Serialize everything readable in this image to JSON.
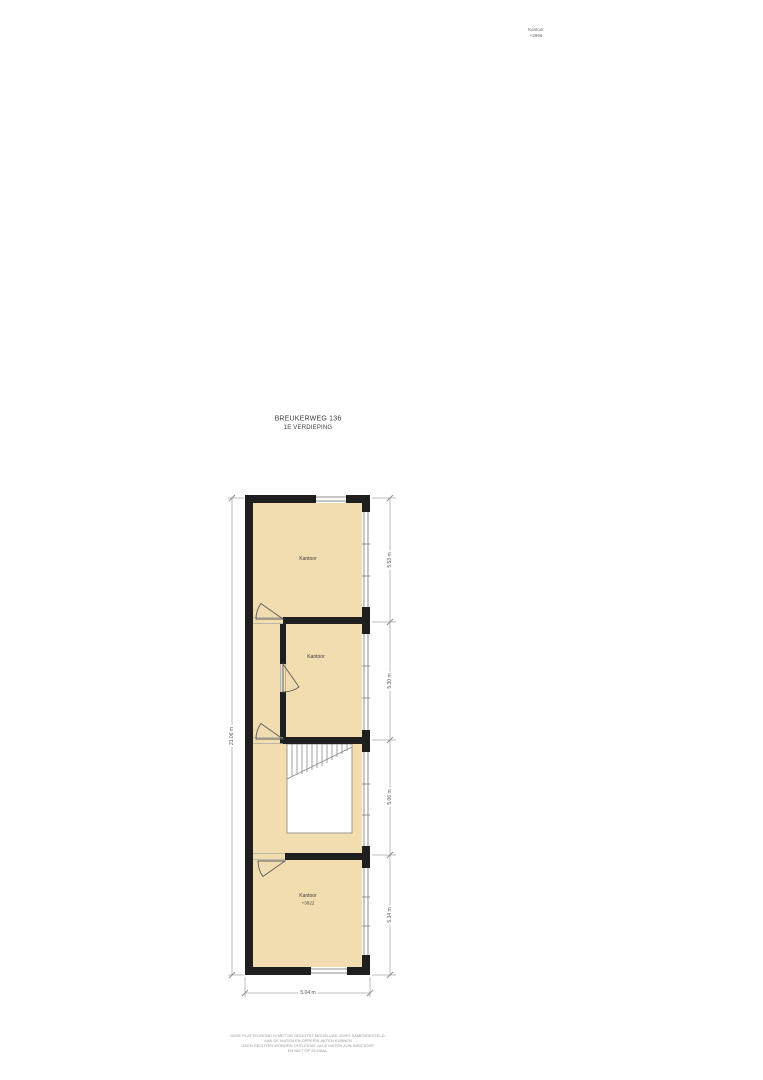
{
  "colors": {
    "room_fill": "#f2ddb0",
    "wall": "#1f1f1f",
    "window_line": "#8f8f8f",
    "dim_line": "#bdbdbd",
    "dim_text": "#555555",
    "label_text": "#3c3c3c",
    "muted_text": "#8f8f8f"
  },
  "header": {
    "address": "BREUKERWEG 136",
    "floor": "1E VERDIEPING"
  },
  "adjacent_fragment": {
    "room": "Kantoor",
    "elevation": "+2966"
  },
  "rooms": {
    "top": {
      "label": "Kantoor"
    },
    "middle": {
      "label": "Kantoor"
    },
    "bottom": {
      "label": "Kantoor",
      "elevation": "+3022"
    }
  },
  "dimensions": {
    "left_total": "21.06 m",
    "right_segment_1": "5.53 m",
    "right_segment_2": "5.30 m",
    "right_segment_3": "5.06 m",
    "right_segment_4": "5.34 m",
    "bottom_width": "5.04 m"
  },
  "disclaimer": {
    "line1": "DEZE PLATTEGROND IS MET DE GROOTST MOGELIJKE ZORG SAMENGESTELD,",
    "line2": "AAN DE MATEN EN OPPERVLAKTEN KUNNEN",
    "line3": "GEEN RECHTEN WORDEN ONTLEEND. ALLE MATEN ZIJN INDICATIEF",
    "line4": "EN NIET OP SCHAAL."
  }
}
